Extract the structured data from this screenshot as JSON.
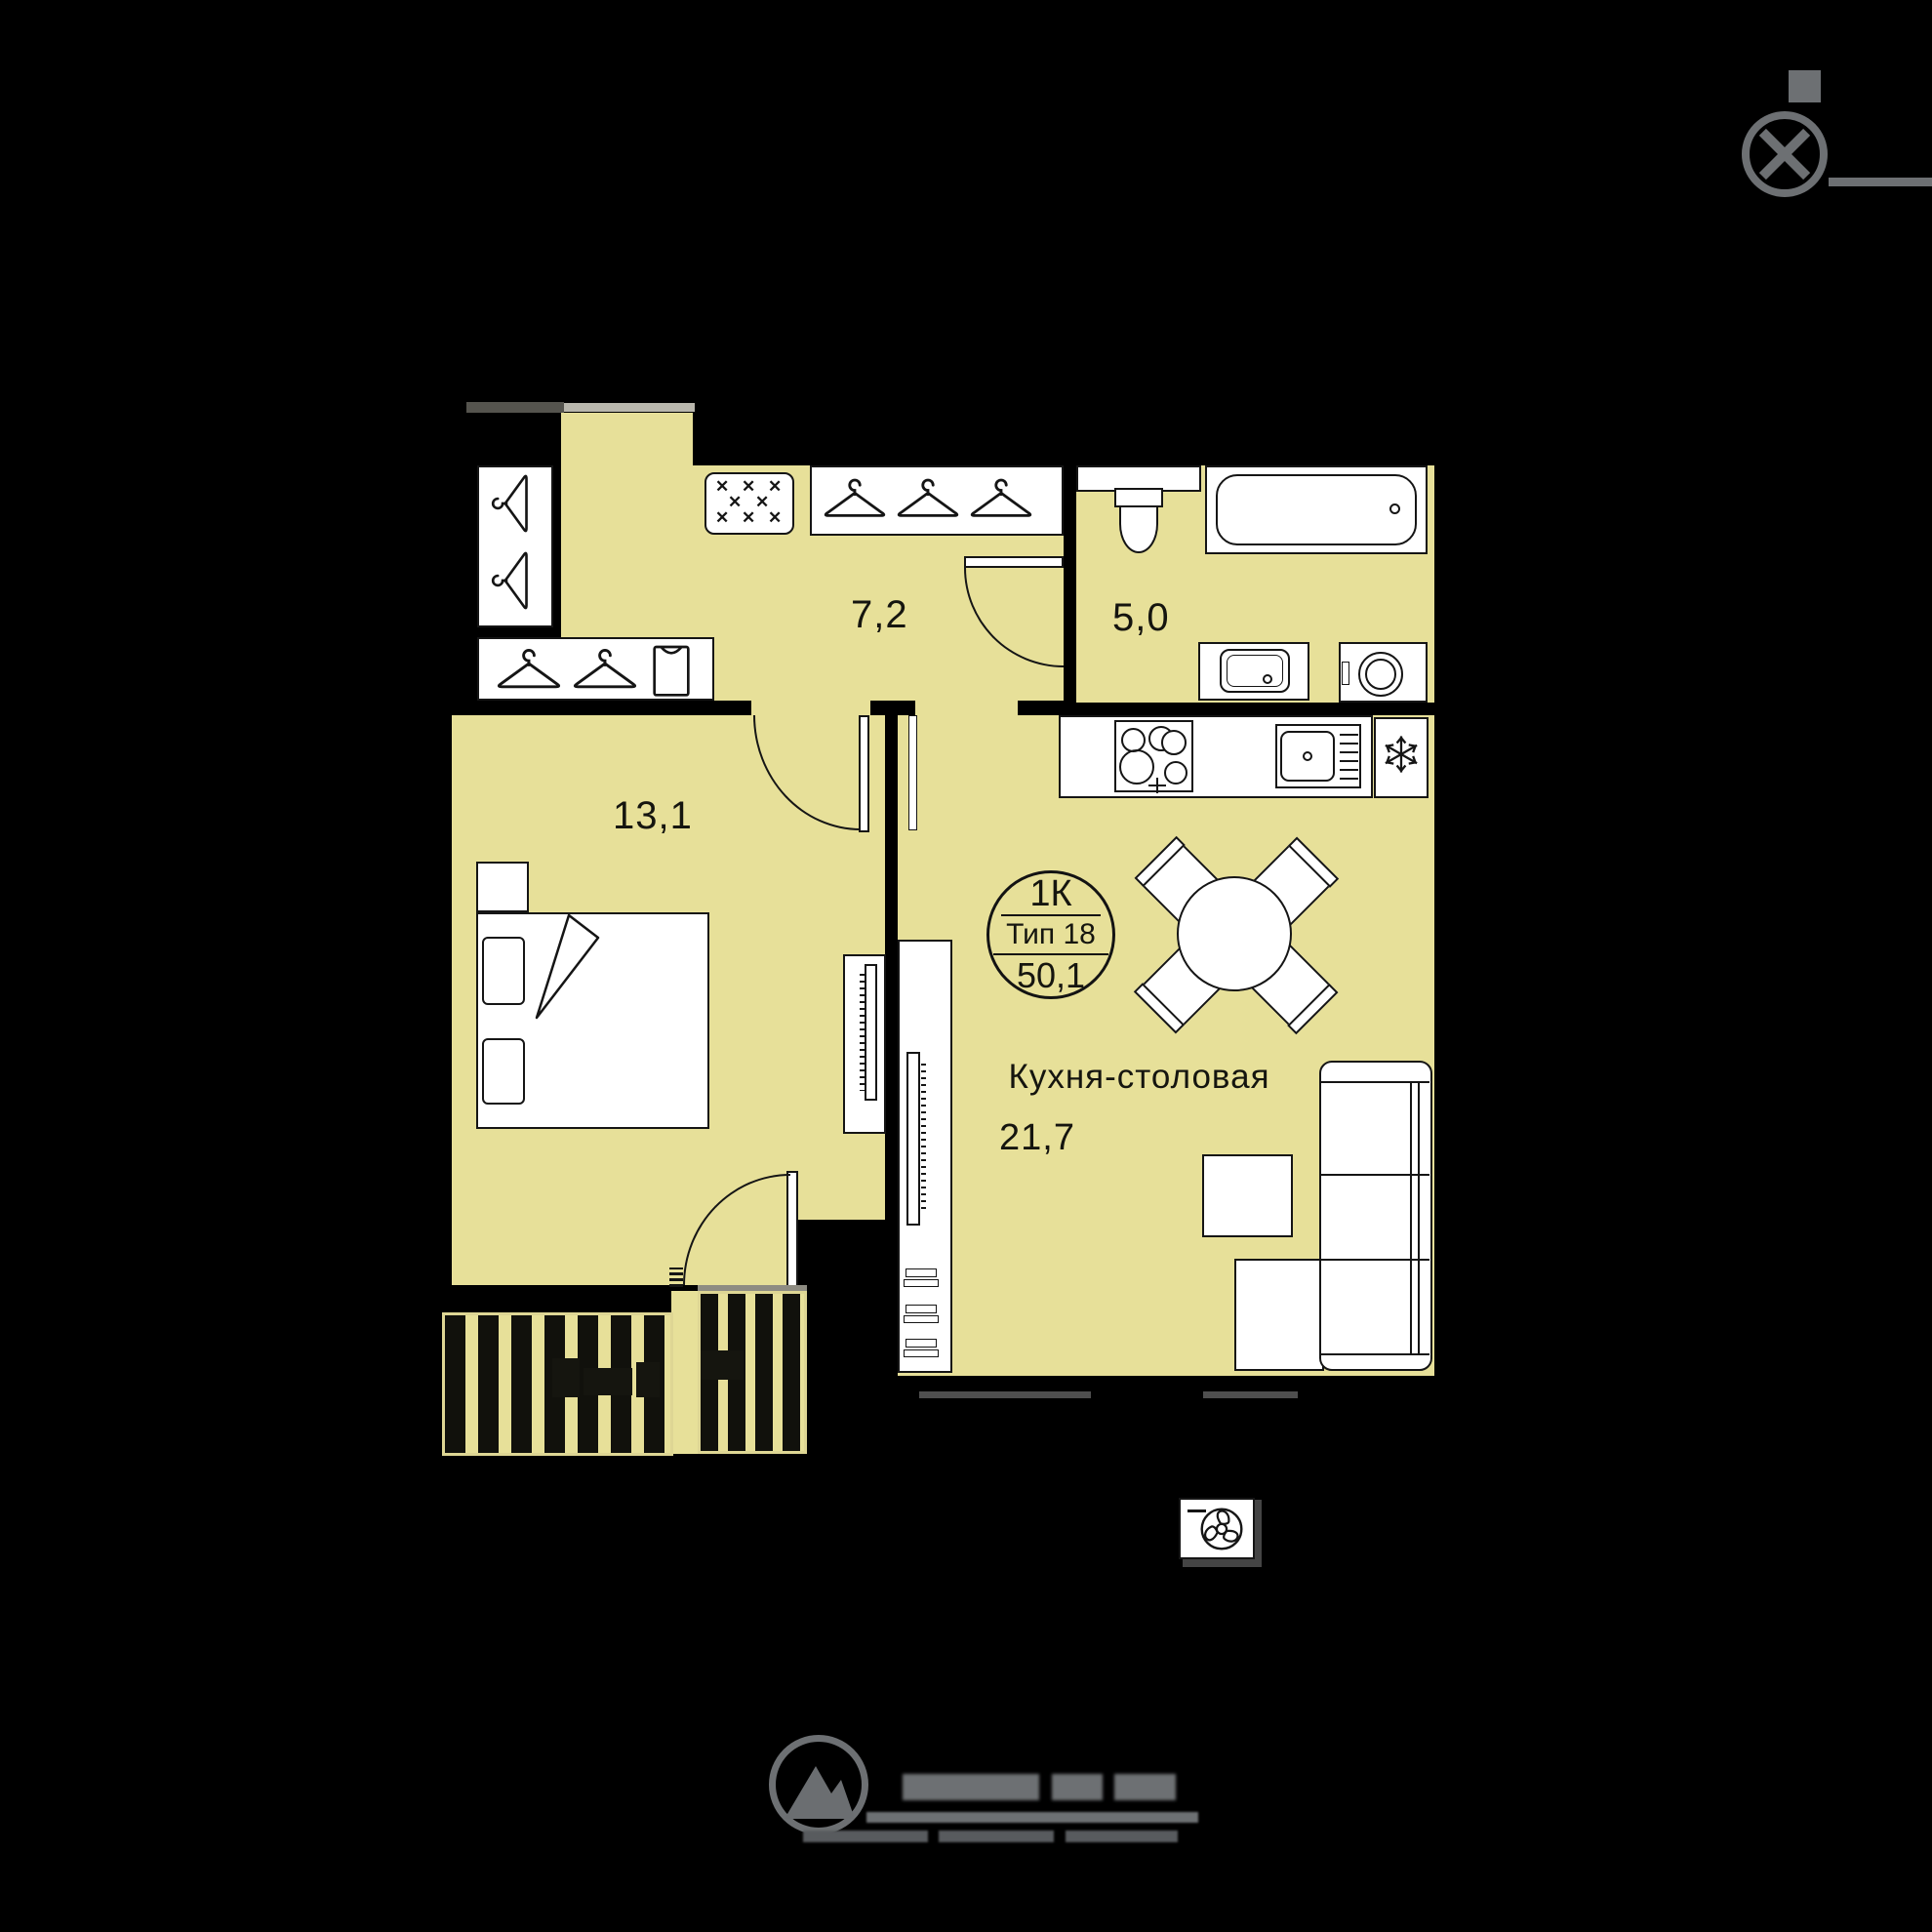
{
  "badge": {
    "rooms_label": "1К",
    "type_label": "Тип 18",
    "total_area": "50,1"
  },
  "rooms": {
    "hallway": {
      "area": "7,2"
    },
    "bathroom": {
      "area": "5,0"
    },
    "bedroom": {
      "area": "13,1"
    },
    "kitchen_dining": {
      "name": "Кухня-столовая",
      "area": "21,7"
    }
  },
  "colors": {
    "background": "#000000",
    "floor": "#e7e099",
    "furniture": "#ffffff",
    "outline": "#151515",
    "accent_gray": "#6d7073",
    "window_gray": "#4f4f4f",
    "threshold_dark": "#55544e",
    "threshold_light": "#b9b7ad"
  },
  "icons": {
    "compass": "compass-rose",
    "hanger": "clothes-hanger",
    "shirt": "folded-shirt",
    "shoe_cabinet": "✕ pattern",
    "fridge": "snowflake ❄",
    "ventilation": "fan in box",
    "logo": "circular mountain mark"
  }
}
